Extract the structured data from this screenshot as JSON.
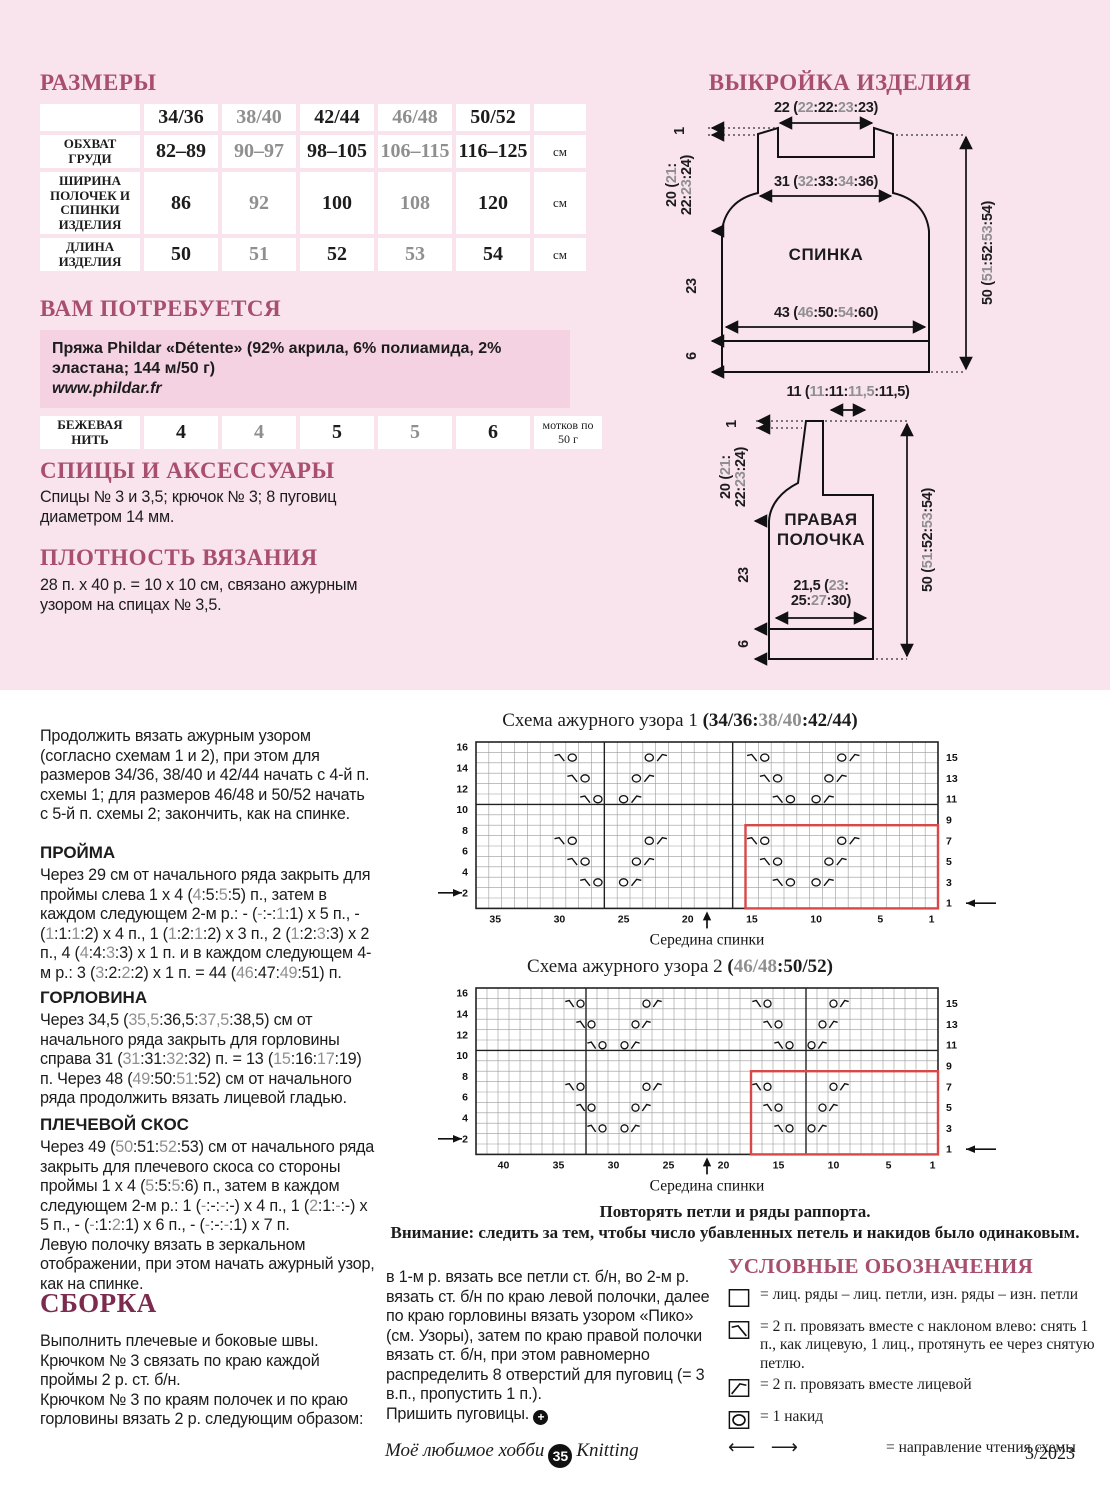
{
  "colors": {
    "page_pink": "#f9e4ee",
    "cell_pink": "#f2cdde",
    "box_pink": "#f5d2e2",
    "heading_rose": "#a84e6e",
    "heading_dark": "#7c2b4e",
    "alt_gray": "#8f8f8f",
    "repeat_red": "#d84848"
  },
  "sizes": {
    "title": "РАЗМЕРЫ",
    "unit_cm": "см",
    "cols": [
      "34/36",
      "38/40",
      "42/44",
      "46/48",
      "50/52"
    ],
    "rows": [
      {
        "label": "ОБХВАТ ГРУДИ",
        "values": [
          "82–89",
          "90–97",
          "98–105",
          "106–115",
          "116–125"
        ]
      },
      {
        "label": "ШИРИНА ПОЛОЧЕК И СПИНКИ ИЗДЕЛИЯ",
        "values": [
          "86",
          "92",
          "100",
          "108",
          "120"
        ]
      },
      {
        "label": "ДЛИНА ИЗДЕЛИЯ",
        "values": [
          "50",
          "51",
          "52",
          "53",
          "54"
        ]
      }
    ]
  },
  "materials": {
    "title": "ВАМ ПОТРЕБУЕТСЯ",
    "yarn": "Пряжа Phildar «Détente» (92% акрила, 6% полиамида, 2% эластана; 144 м/50 г)",
    "url": "www.phildar.fr",
    "thread_label": "БЕЖЕВАЯ НИТЬ",
    "thread_values": [
      "4",
      "4",
      "5",
      "5",
      "6"
    ],
    "thread_unit": "мотков по 50 г"
  },
  "needles": {
    "title": "СПИЦЫ И АКСЕССУАРЫ",
    "text": "Спицы № 3 и 3,5; крючок № 3; 8 пуговиц диаметром 14 мм."
  },
  "gauge": {
    "title": "ПЛОТНОСТЬ ВЯЗАНИЯ",
    "text": "28 п. х 40 р. = 10 х 10 см, связано ажурным узором на спицах № 3,5."
  },
  "layout": {
    "title": "ВЫКРОЙКА ИЗДЕЛИЯ",
    "back": {
      "name": "СПИНКА",
      "top": "22 (22:22:23:23)",
      "shoulder": "31 (32:33:34:36)",
      "bottom": "43 (46:50:54:60)",
      "height": "50 (51:52:53:54)",
      "left1": "1",
      "left2": "20 (21: 22:23:24)",
      "left3": "23",
      "left4": "6"
    },
    "front": {
      "name": "ПРАВАЯ ПОЛОЧКА",
      "top": "11 (11:11:11,5:11,5)",
      "width": "21,5 (23: 25:27:30)",
      "height": "50 (51:52:53:54)",
      "left1": "1",
      "left2": "20 (21: 22:23:24)",
      "left3": "23",
      "left4": "6"
    }
  },
  "text": {
    "intro": "Продолжить вязать ажурным узором (согласно схемам 1 и 2), при этом для размеров 34/36, 38/40 и 42/44 начать с 4-й п. схемы 1; для размеров 46/48 и 50/52 начать с 5-й п. схемы 2; закончить, как на спинке.",
    "proyma_h": "ПРОЙМА",
    "proyma": "Через 29 см от начального ряда закрыть для проймы слева 1 х 4 (4:5:5:5) п., затем в каждом следующем 2-м р.: - (-:-:1:1) х 5 п., - (1:1:1:2) х 4 п., 1 (1:2:1:2) х 3 п., 2 (1:2:3:3) х 2 п., 4 (4:4:3:3) х 1 п. и в каждом следующем 4-м р.: 3 (3:2:2:2) х 1 п. = 44 (46:47:49:51) п.",
    "gorl_h": "ГОРЛОВИНА",
    "gorl": "Через 34,5 (35,5:36,5:37,5:38,5) см от начального ряда закрыть для горловины справа 31 (31:31:32:32) п. = 13 (15:16:17:19) п. Через 48 (49:50:51:52) см от начального ряда продолжить вязать лицевой гладью.",
    "skos_h": "ПЛЕЧЕВОЙ СКОС",
    "skos": "Через 49 (50:51:52:53) см от начального ряда закрыть для плечевого скоса со стороны проймы 1 х 4 (5:5:5:6) п., затем в каждом следующем 2-м р.: 1 (-:-:-:-) х 4 п., 1 (2:1:-:-) х 5 п., - (-:1:2:1) х 6 п., - (-:-:-:1) х 7 п.\nЛевую полочку вязать в зеркальном отображении, при этом начать ажурный узор, как на спинке.",
    "sborka_h": "СБОРКА",
    "sborka": "Выполнить плечевые и боковые швы.\nКрючком № 3 связать по краю каждой проймы 2 р. ст. б/н.\nКрючком № 3 по краям полочек и по краю горловины вязать 2 р. следующим образом:",
    "sborka2": "в 1-м р. вязать все петли ст. б/н, во 2-м р. вязать ст. б/н по краю левой полочки, далее по краю горловины вязать узором «Пико» (см. Узоры), затем по краю правой полочки вязать ст. б/н, при этом равномерно распределить 8 отверстий для пуговиц (= 3 в.п., пропустить 1 п.).",
    "finish": "Пришить пуговицы."
  },
  "charts": [
    {
      "title": "Схема ажурного узора 1 ",
      "sizes": "(34/36:38/40:42/44)",
      "cols": 36,
      "rows": 16,
      "left_labels": [
        16,
        14,
        12,
        10,
        8,
        6,
        4,
        2
      ],
      "right_labels": [
        15,
        13,
        11,
        9,
        7,
        5,
        3,
        1
      ],
      "bottom_labels": [
        35,
        30,
        25,
        20,
        15,
        10,
        5,
        1
      ],
      "heavy_cols": [
        16,
        26
      ],
      "heavy_row": 10,
      "repeat_cols": 15,
      "repeat_rows": 8,
      "arrow_left_row": 2,
      "arrow_right_row": 1,
      "mid_col": 18.5,
      "mid_label": "Середина спинки",
      "symbols": [
        [
          15,
          30,
          "s"
        ],
        [
          15,
          29,
          "o"
        ],
        [
          15,
          23,
          "o"
        ],
        [
          15,
          22,
          "k"
        ],
        [
          15,
          15,
          "s"
        ],
        [
          15,
          14,
          "o"
        ],
        [
          15,
          8,
          "o"
        ],
        [
          15,
          7,
          "k"
        ],
        [
          13,
          29,
          "s"
        ],
        [
          13,
          28,
          "o"
        ],
        [
          13,
          24,
          "o"
        ],
        [
          13,
          23,
          "k"
        ],
        [
          13,
          14,
          "s"
        ],
        [
          13,
          13,
          "o"
        ],
        [
          13,
          9,
          "o"
        ],
        [
          13,
          8,
          "k"
        ],
        [
          11,
          28,
          "s"
        ],
        [
          11,
          27,
          "o"
        ],
        [
          11,
          25,
          "o"
        ],
        [
          11,
          24,
          "k"
        ],
        [
          11,
          13,
          "s"
        ],
        [
          11,
          12,
          "o"
        ],
        [
          11,
          10,
          "o"
        ],
        [
          11,
          9,
          "k"
        ],
        [
          7,
          30,
          "s"
        ],
        [
          7,
          29,
          "o"
        ],
        [
          7,
          23,
          "o"
        ],
        [
          7,
          22,
          "k"
        ],
        [
          7,
          15,
          "s"
        ],
        [
          7,
          14,
          "o"
        ],
        [
          7,
          8,
          "o"
        ],
        [
          7,
          7,
          "k"
        ],
        [
          5,
          29,
          "s"
        ],
        [
          5,
          28,
          "o"
        ],
        [
          5,
          24,
          "o"
        ],
        [
          5,
          23,
          "k"
        ],
        [
          5,
          14,
          "s"
        ],
        [
          5,
          13,
          "o"
        ],
        [
          5,
          9,
          "o"
        ],
        [
          5,
          8,
          "k"
        ],
        [
          3,
          28,
          "s"
        ],
        [
          3,
          27,
          "o"
        ],
        [
          3,
          25,
          "o"
        ],
        [
          3,
          24,
          "k"
        ],
        [
          3,
          13,
          "s"
        ],
        [
          3,
          12,
          "o"
        ],
        [
          3,
          10,
          "o"
        ],
        [
          3,
          9,
          "k"
        ]
      ]
    },
    {
      "title": "Схема ажурного узора 2 ",
      "sizes": "(46/48:50/52)",
      "cols": 42,
      "rows": 16,
      "left_labels": [
        16,
        14,
        12,
        10,
        8,
        6,
        4,
        2
      ],
      "right_labels": [
        15,
        13,
        11,
        9,
        7,
        5,
        3,
        1
      ],
      "bottom_labels": [
        40,
        35,
        30,
        25,
        20,
        15,
        10,
        5,
        1
      ],
      "heavy_cols": [
        12,
        32
      ],
      "heavy_row": 10,
      "repeat_cols": 17,
      "repeat_rows": 8,
      "arrow_left_row": 2,
      "arrow_right_row": 1,
      "mid_col": 21.5,
      "mid_label": "Середина спинки",
      "symbols": [
        [
          15,
          34,
          "s"
        ],
        [
          15,
          33,
          "o"
        ],
        [
          15,
          27,
          "o"
        ],
        [
          15,
          26,
          "k"
        ],
        [
          15,
          17,
          "s"
        ],
        [
          15,
          16,
          "o"
        ],
        [
          15,
          10,
          "o"
        ],
        [
          15,
          9,
          "k"
        ],
        [
          13,
          33,
          "s"
        ],
        [
          13,
          32,
          "o"
        ],
        [
          13,
          28,
          "o"
        ],
        [
          13,
          27,
          "k"
        ],
        [
          13,
          16,
          "s"
        ],
        [
          13,
          15,
          "o"
        ],
        [
          13,
          11,
          "o"
        ],
        [
          13,
          10,
          "k"
        ],
        [
          11,
          32,
          "s"
        ],
        [
          11,
          31,
          "o"
        ],
        [
          11,
          29,
          "o"
        ],
        [
          11,
          28,
          "k"
        ],
        [
          11,
          15,
          "s"
        ],
        [
          11,
          14,
          "o"
        ],
        [
          11,
          12,
          "o"
        ],
        [
          11,
          11,
          "k"
        ],
        [
          7,
          34,
          "s"
        ],
        [
          7,
          33,
          "o"
        ],
        [
          7,
          27,
          "o"
        ],
        [
          7,
          26,
          "k"
        ],
        [
          7,
          17,
          "s"
        ],
        [
          7,
          16,
          "o"
        ],
        [
          7,
          10,
          "o"
        ],
        [
          7,
          9,
          "k"
        ],
        [
          5,
          33,
          "s"
        ],
        [
          5,
          32,
          "o"
        ],
        [
          5,
          28,
          "o"
        ],
        [
          5,
          27,
          "k"
        ],
        [
          5,
          16,
          "s"
        ],
        [
          5,
          15,
          "o"
        ],
        [
          5,
          11,
          "o"
        ],
        [
          5,
          10,
          "k"
        ],
        [
          3,
          32,
          "s"
        ],
        [
          3,
          31,
          "o"
        ],
        [
          3,
          29,
          "o"
        ],
        [
          3,
          28,
          "k"
        ],
        [
          3,
          15,
          "s"
        ],
        [
          3,
          14,
          "o"
        ],
        [
          3,
          12,
          "o"
        ],
        [
          3,
          11,
          "k"
        ]
      ]
    }
  ],
  "notes": {
    "n1": "Повторять петли и ряды раппорта.",
    "n2": "Внимание: следить за тем, чтобы число убавленных петель и накидов было одинаковым."
  },
  "legend": {
    "title": "УСЛОВНЫЕ ОБОЗНАЧЕНИЯ",
    "items": [
      "= лиц. ряды – лиц. петли, изн. ряды – изн. петли",
      "= 2 п. провязать вместе с наклоном влево: снять 1 п., как лицевую, 1 лиц., протянуть ее через снятую петлю.",
      "= 2 п. провязать вместе лицевой",
      "= 1 накид",
      "= направление чтения схемы"
    ]
  },
  "footer": {
    "magazine": "Моё любимое хобби",
    "page": "35",
    "brand": "Knitting",
    "issue": "3/2023"
  }
}
